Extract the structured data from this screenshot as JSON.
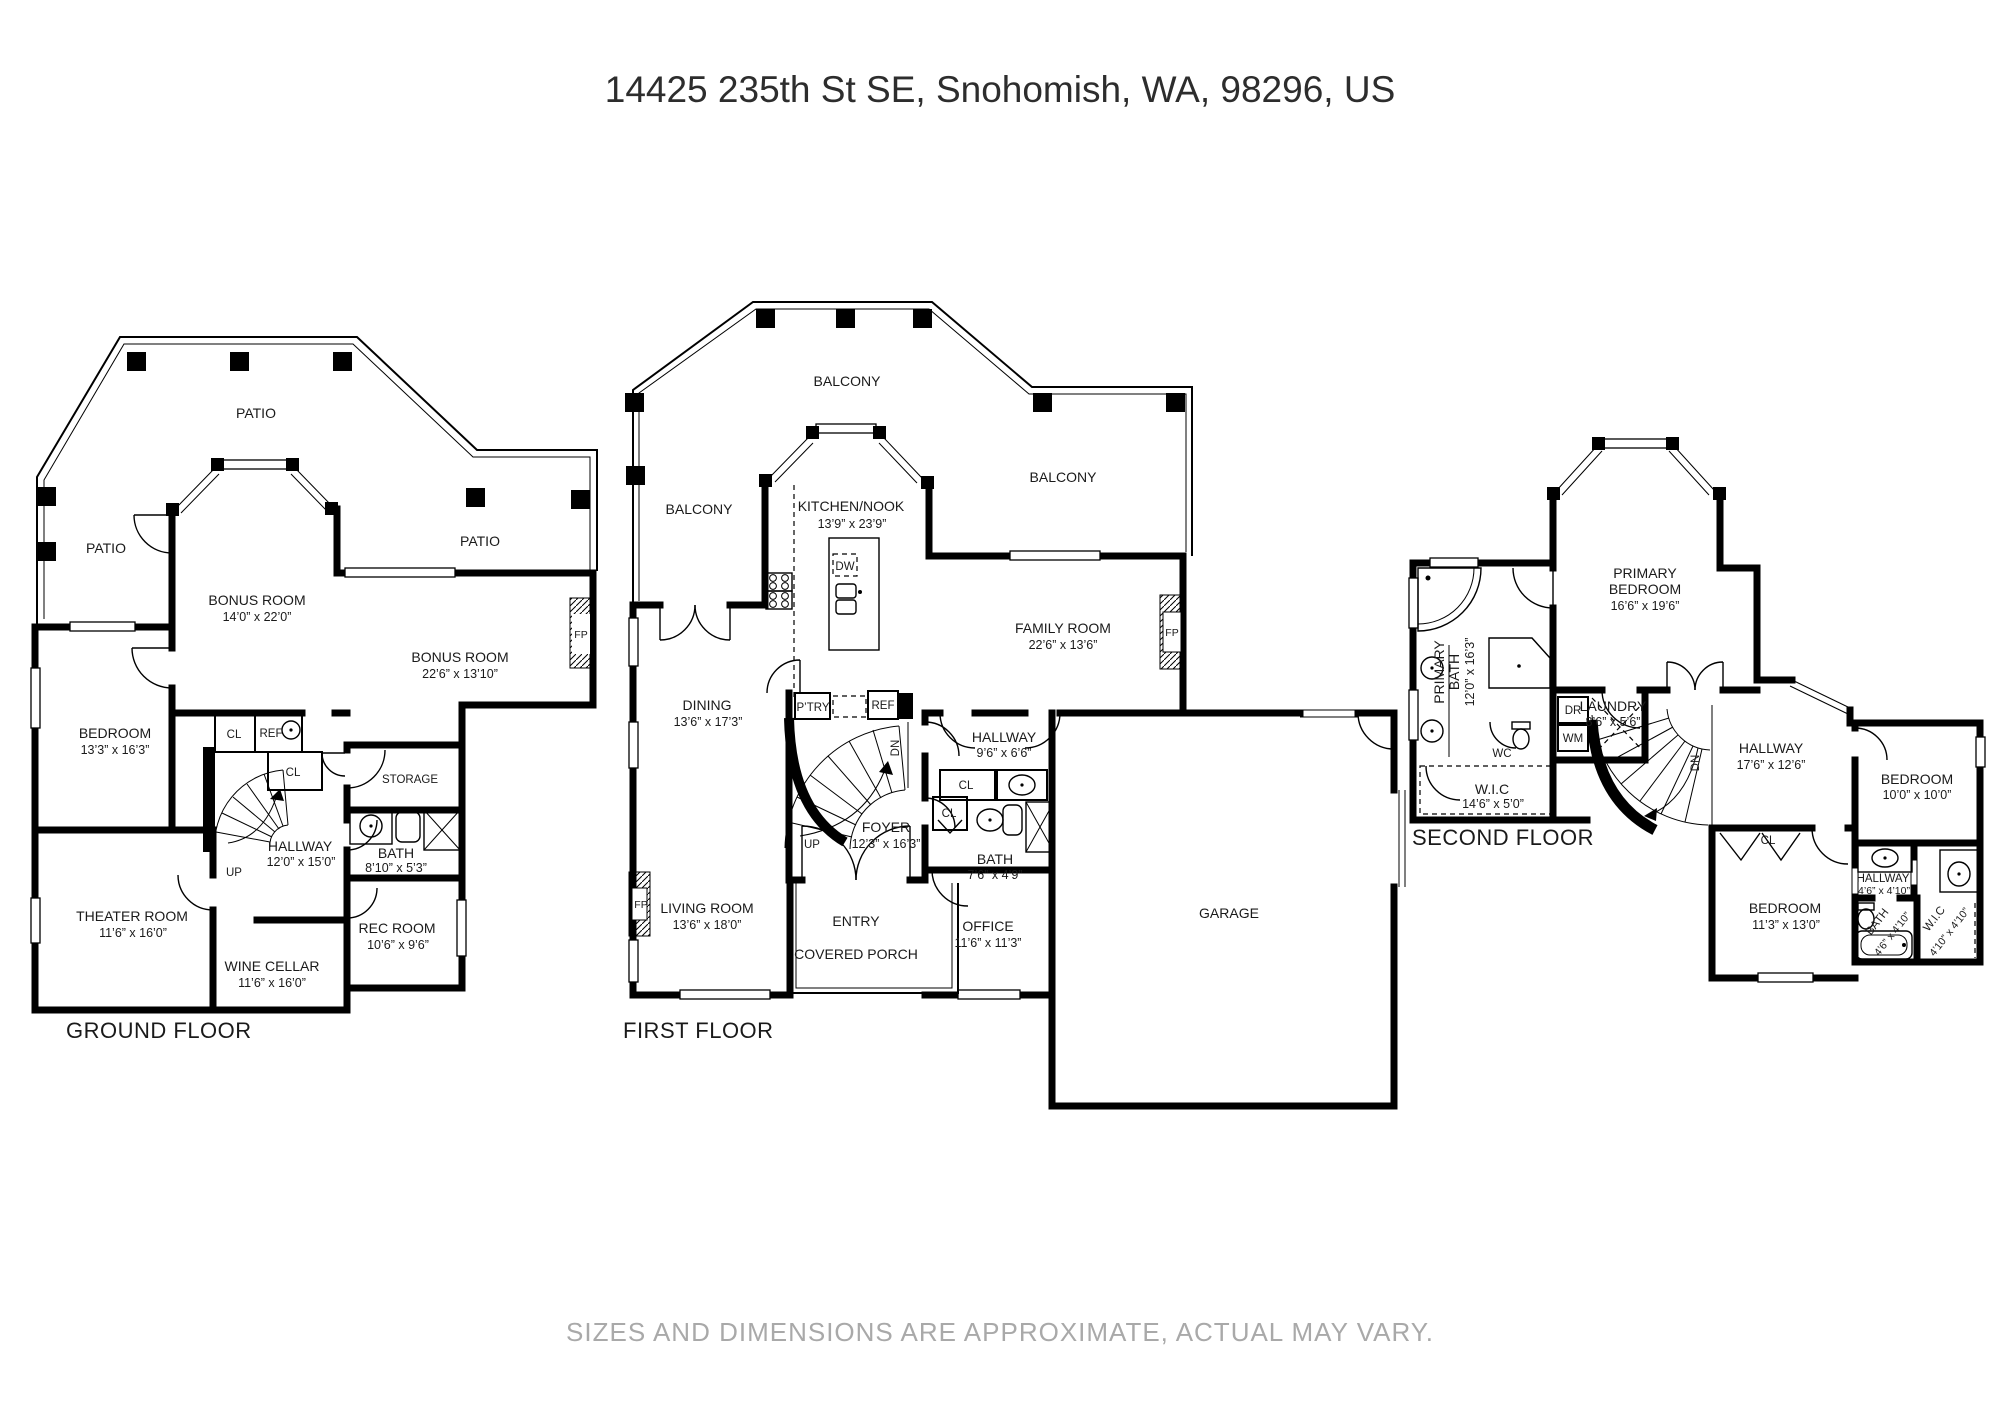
{
  "title": "14425 235th St SE, Snohomish, WA, 98296, US",
  "disclaimer": "SIZES AND DIMENSIONS ARE APPROXIMATE, ACTUAL MAY VARY.",
  "ground": {
    "floor_label": "GROUND FLOOR",
    "patio_top": "PATIO",
    "patio_left": "PATIO",
    "patio_right": "PATIO",
    "bonus1_name": "BONUS ROOM",
    "bonus1_dims": "14’0” x 22’0”",
    "bonus2_name": "BONUS ROOM",
    "bonus2_dims": "22’6” x 13’10”",
    "bedroom_name": "BEDROOM",
    "bedroom_dims": "13’3” x 16’3”",
    "cl1": "CL",
    "ref": "REF",
    "cl2": "CL",
    "storage": "STORAGE",
    "hallway_name": "HALLWAY",
    "hallway_dims": "12’0” x 15’0”",
    "bath_name": "BATH",
    "bath_dims": "8’10” x 5’3”",
    "up": "UP",
    "theater_name": "THEATER ROOM",
    "theater_dims": "11’6” x 16’0”",
    "wine_name": "WINE CELLAR",
    "wine_dims": "11’6” x 16’0”",
    "rec_name": "REC ROOM",
    "rec_dims": "10’6” x 9’6”",
    "fp": "FP"
  },
  "first": {
    "floor_label": "FIRST FLOOR",
    "balcony_top": "BALCONY",
    "balcony_left": "BALCONY",
    "balcony_right": "BALCONY",
    "kitchen_name": "KITCHEN/NOOK",
    "kitchen_dims": "13’9” x 23’9”",
    "dw": "DW",
    "family_name": "FAMILY ROOM",
    "family_dims": "22’6” x 13’6”",
    "fp1": "FP",
    "fp2": "FP",
    "dining_name": "DINING",
    "dining_dims": "13’6” x 17’3”",
    "ptry": "P’TRY",
    "ref": "REF",
    "dn": "DN",
    "up": "UP",
    "hallway_name": "HALLWAY",
    "hallway_dims": "9’6” x 6’6”",
    "cl1": "CL",
    "cl2": "CL",
    "foyer_name": "FOYER",
    "foyer_dims": "12’3” x 16’3”",
    "bath_name": "BATH",
    "bath_dims": "7’6” x 4’9”",
    "living_name": "LIVING ROOM",
    "living_dims": "13’6” x 18’0”",
    "entry": "ENTRY",
    "office_name": "OFFICE",
    "office_dims": "11’6” x 11’3”",
    "porch": "COVERED PORCH",
    "garage": "GARAGE"
  },
  "second": {
    "floor_label": "SECOND FLOOR",
    "primary_bedroom_l1": "PRIMARY",
    "primary_bedroom_l2": "BEDROOM",
    "primary_bedroom_dims": "16’6” x 19’6”",
    "primary_bath_l1": "PRIMARY",
    "primary_bath_l2": "BATH",
    "primary_bath_dims": "12’0” x 16’3”",
    "wc": "WC",
    "wic1_name": "W.I.C",
    "wic1_dims": "14’6” x 5’0”",
    "dr": "DR",
    "wm": "WM",
    "laundry_name": "LAUNDRY",
    "laundry_dims": "8’6” x 5’6”",
    "dn": "DN",
    "hallway_name": "HALLWAY",
    "hallway_dims": "17’6” x 12’6”",
    "bedroom2_name": "BEDROOM",
    "bedroom2_dims": "10’0” x 10’0”",
    "cl": "CL",
    "bedroom3_name": "BEDROOM",
    "bedroom3_dims": "11’3” x 13’0”",
    "hallway2_name": "HALLWAY",
    "hallway2_dims": "4’6” x 4’10”",
    "bath2_name": "BATH",
    "bath2_dims": "4’6” x 4’10”",
    "wic2_name": "W.I.C",
    "wic2_dims": "4’10” x 4’10”"
  }
}
